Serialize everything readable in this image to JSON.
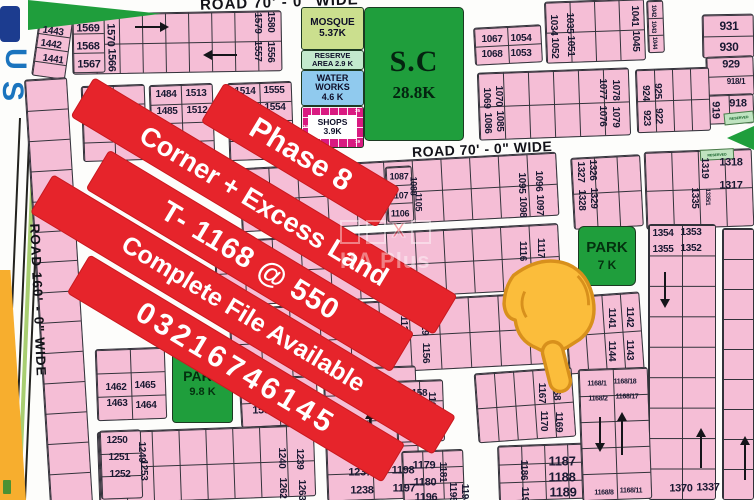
{
  "page": {
    "width": 754,
    "height": 500
  },
  "colors": {
    "plot_pink": "#F5BED6",
    "block_line": "#32323a",
    "label_text": "#191932",
    "green": "#1F9E3C",
    "mosque_green": "#CBDF8E",
    "reserve_green": "#C3E9CD",
    "water_blue": "#90CAEE",
    "shops_magenta": "#D91A81",
    "banner_red": "#E6242B",
    "banner_text": "#FFFFFF",
    "hand_fill": "#FBBD3B",
    "hand_stroke": "#D8901C",
    "orange_strip": "#F7AE2E",
    "blue_edge": "#1B74BE",
    "median_green": "#A8CE71"
  },
  "roads": {
    "top": "ROAD 70' - 0\" WIDE",
    "middle": "ROAD 70' - 0\" WIDE",
    "left": "ROAD 160' - 0\" WIDE"
  },
  "banner": {
    "rotation_deg": 31,
    "lines": [
      {
        "text": "Phase 8",
        "cx": 300,
        "cy": 155,
        "w": 205,
        "h": 46,
        "fs": 30,
        "ls": 0
      },
      {
        "text": "Corner + Excess Land",
        "cx": 264,
        "cy": 206,
        "w": 424,
        "h": 46,
        "fs": 27,
        "ls": 0
      },
      {
        "text": "T- 1168 @ 550",
        "cx": 250,
        "cy": 261,
        "w": 356,
        "h": 46,
        "fs": 29,
        "ls": 1
      },
      {
        "text": "Complete File Available",
        "cx": 243,
        "cy": 314,
        "w": 470,
        "h": 45,
        "fs": 25,
        "ls": 0
      },
      {
        "text": "03216746145",
        "cx": 236,
        "cy": 368,
        "w": 368,
        "h": 45,
        "fs": 30,
        "ls": 4
      }
    ]
  },
  "amenities": {
    "mosque": {
      "line1": "MOSQUE",
      "line2": "5.37K"
    },
    "reserve": {
      "line1": "RESERVE",
      "line2": "AREA  2.9 K"
    },
    "water": {
      "line1": "WATER",
      "line2": "WORKS",
      "line3": "4.6 K"
    },
    "shops": {
      "line1": "SHOPS",
      "line2": "3.9K",
      "cells": [
        "34",
        "35",
        "19"
      ]
    },
    "sc": {
      "line1": "S.C",
      "line2": "28.8K"
    },
    "park7": {
      "line1": "PARK",
      "line2": "7 K"
    },
    "park98": {
      "line1": "PARK",
      "line2": "9.8 K"
    },
    "reserved_label": "RESERVED"
  },
  "edge_letters": [
    "U",
    "S"
  ],
  "watermark": {
    "text": "HA Plus",
    "x_glyph": "X"
  },
  "blocks": [
    {
      "x": 35,
      "y": 20,
      "w": 34,
      "h": 58,
      "r": 8,
      "c": 1,
      "rw": 4
    },
    {
      "x": 72,
      "y": 12,
      "w": 210,
      "h": 61,
      "r": -1,
      "c": 9,
      "rw": 2
    },
    {
      "x": 72,
      "y": 13,
      "w": 33,
      "h": 60,
      "r": -1,
      "c": 1,
      "rw": 3
    },
    {
      "x": 82,
      "y": 85,
      "w": 64,
      "h": 76,
      "r": -2,
      "c": 2,
      "rw": 4
    },
    {
      "x": 150,
      "y": 84,
      "w": 64,
      "h": 77,
      "r": -2,
      "c": 2,
      "rw": 4
    },
    {
      "x": 228,
      "y": 82,
      "w": 65,
      "h": 78,
      "r": -2,
      "c": 2,
      "rw": 4
    },
    {
      "x": 474,
      "y": 26,
      "w": 68,
      "h": 38,
      "r": -3,
      "c": 2,
      "rw": 2
    },
    {
      "x": 545,
      "y": 0,
      "w": 100,
      "h": 62,
      "r": -2,
      "c": 4,
      "rw": 2
    },
    {
      "x": 647,
      "y": 0,
      "w": 17,
      "h": 53,
      "r": -2,
      "c": 1,
      "rw": 3
    },
    {
      "x": 702,
      "y": 14,
      "w": 52,
      "h": 44,
      "r": -1,
      "c": 1,
      "rw": 2
    },
    {
      "x": 706,
      "y": 56,
      "w": 48,
      "h": 40,
      "r": -2,
      "c": 1,
      "rw": 2
    },
    {
      "x": 704,
      "y": 94,
      "w": 50,
      "h": 30,
      "r": -2,
      "c": 2,
      "rw": 1
    },
    {
      "x": 636,
      "y": 68,
      "w": 74,
      "h": 64,
      "r": -2,
      "c": 4,
      "rw": 2
    },
    {
      "x": 478,
      "y": 70,
      "w": 152,
      "h": 68,
      "r": -2,
      "c": 6,
      "rw": 2
    },
    {
      "x": 240,
      "y": 160,
      "w": 318,
      "h": 64,
      "r": -3,
      "c": 11,
      "rw": 2
    },
    {
      "x": 386,
      "y": 166,
      "w": 27,
      "h": 56,
      "r": -3,
      "c": 1,
      "rw": 3
    },
    {
      "x": 572,
      "y": 156,
      "w": 70,
      "h": 72,
      "r": -3,
      "c": 3,
      "rw": 2
    },
    {
      "x": 645,
      "y": 150,
      "w": 108,
      "h": 78,
      "r": -2,
      "c": 4,
      "rw": 2
    },
    {
      "x": 215,
      "y": 232,
      "w": 345,
      "h": 66,
      "r": -3,
      "c": 12,
      "rw": 2
    },
    {
      "x": 648,
      "y": 224,
      "w": 68,
      "h": 276,
      "r": 0,
      "c": 2,
      "rw": 9
    },
    {
      "x": 722,
      "y": 228,
      "w": 32,
      "h": 272,
      "r": 0,
      "c": 1,
      "rw": 9
    },
    {
      "x": 566,
      "y": 294,
      "w": 76,
      "h": 78,
      "r": -4,
      "c": 4,
      "rw": 2
    },
    {
      "x": 230,
      "y": 300,
      "w": 330,
      "h": 72,
      "r": -3,
      "c": 11,
      "rw": 2
    },
    {
      "x": 37,
      "y": 78,
      "w": 43,
      "h": 427,
      "r": -3.5,
      "c": 1,
      "rw": 14
    },
    {
      "x": 96,
      "y": 348,
      "w": 70,
      "h": 72,
      "r": -2,
      "c": 2,
      "rw": 3
    },
    {
      "x": 240,
      "y": 377,
      "w": 78,
      "h": 49,
      "r": -3,
      "c": 2,
      "rw": 2
    },
    {
      "x": 98,
      "y": 428,
      "w": 217,
      "h": 72,
      "r": -2,
      "c": 8,
      "rw": 2
    },
    {
      "x": 100,
      "y": 430,
      "w": 42,
      "h": 69,
      "r": -2,
      "c": 1,
      "rw": 3
    },
    {
      "x": 325,
      "y": 367,
      "w": 93,
      "h": 133,
      "r": -2,
      "c": 2,
      "rw": 5
    },
    {
      "x": 396,
      "y": 380,
      "w": 48,
      "h": 62,
      "r": -2,
      "c": 2,
      "rw": 3
    },
    {
      "x": 402,
      "y": 450,
      "w": 62,
      "h": 50,
      "r": -2,
      "c": 3,
      "rw": 3
    },
    {
      "x": 476,
      "y": 370,
      "w": 98,
      "h": 70,
      "r": -4,
      "c": 5,
      "rw": 2
    },
    {
      "x": 498,
      "y": 444,
      "w": 94,
      "h": 56,
      "r": -2,
      "c": 4,
      "rw": 3
    },
    {
      "x": 580,
      "y": 368,
      "w": 70,
      "h": 132,
      "r": -2,
      "c": 2,
      "rw": 5
    }
  ],
  "plot_labels": [
    {
      "t": "1443",
      "x": 53,
      "y": 32,
      "r": 8
    },
    {
      "t": "1442",
      "x": 51,
      "y": 45,
      "r": 8
    },
    {
      "t": "1441",
      "x": 53,
      "y": 60,
      "r": 8
    },
    {
      "t": "1569",
      "x": 88,
      "y": 29,
      "s": 11
    },
    {
      "t": "1568",
      "x": 88,
      "y": 47,
      "s": 11
    },
    {
      "t": "1567",
      "x": 89,
      "y": 65,
      "s": 11
    },
    {
      "t": "1570",
      "x": 110,
      "y": 35,
      "r": 90,
      "s": 11
    },
    {
      "t": "1566",
      "x": 111,
      "y": 60,
      "r": 90,
      "s": 11
    },
    {
      "t": "1579",
      "x": 257,
      "y": 23,
      "r": 90
    },
    {
      "t": "1580",
      "x": 270,
      "y": 22,
      "r": 90
    },
    {
      "t": "1557",
      "x": 257,
      "y": 51,
      "r": 90
    },
    {
      "t": "1556",
      "x": 270,
      "y": 52,
      "r": 90
    },
    {
      "t": "1444",
      "x": 97,
      "y": 99
    },
    {
      "t": "1445",
      "x": 97,
      "y": 116
    },
    {
      "t": "1484",
      "x": 166,
      "y": 95
    },
    {
      "t": "1513",
      "x": 196,
      "y": 94
    },
    {
      "t": "1485",
      "x": 167,
      "y": 112
    },
    {
      "t": "1512",
      "x": 197,
      "y": 111
    },
    {
      "t": "1514",
      "x": 245,
      "y": 92
    },
    {
      "t": "1555",
      "x": 274,
      "y": 91
    },
    {
      "t": "1515",
      "x": 247,
      "y": 109
    },
    {
      "t": "1554",
      "x": 275,
      "y": 108
    },
    {
      "t": "1067",
      "x": 492,
      "y": 40
    },
    {
      "t": "1054",
      "x": 521,
      "y": 39
    },
    {
      "t": "1068",
      "x": 492,
      "y": 55
    },
    {
      "t": "1053",
      "x": 521,
      "y": 54
    },
    {
      "t": "1034",
      "x": 553,
      "y": 25,
      "r": 90
    },
    {
      "t": "1052",
      "x": 554,
      "y": 48,
      "r": 90
    },
    {
      "t": "1035",
      "x": 569,
      "y": 23,
      "r": 90
    },
    {
      "t": "1051",
      "x": 570,
      "y": 46,
      "r": 90
    },
    {
      "t": "1041",
      "x": 634,
      "y": 16,
      "r": 90
    },
    {
      "t": "1045",
      "x": 635,
      "y": 41,
      "r": 90
    },
    {
      "t": "1042",
      "x": 653,
      "y": 11,
      "r": 90,
      "s": 6
    },
    {
      "t": "1043",
      "x": 653,
      "y": 27,
      "r": 90,
      "s": 6
    },
    {
      "t": "1044",
      "x": 654,
      "y": 43,
      "r": 90,
      "s": 6
    },
    {
      "t": "931",
      "x": 729,
      "y": 26,
      "s": 12
    },
    {
      "t": "930",
      "x": 729,
      "y": 47,
      "s": 12
    },
    {
      "t": "929",
      "x": 731,
      "y": 65,
      "s": 11
    },
    {
      "t": "918/1",
      "x": 736,
      "y": 82,
      "s": 8
    },
    {
      "t": "918",
      "x": 738,
      "y": 104,
      "s": 11
    },
    {
      "t": "919",
      "x": 715,
      "y": 110,
      "r": 90,
      "s": 11
    },
    {
      "t": "924",
      "x": 645,
      "y": 93,
      "r": 90
    },
    {
      "t": "925",
      "x": 657,
      "y": 91,
      "r": 90
    },
    {
      "t": "923",
      "x": 646,
      "y": 118,
      "r": 90
    },
    {
      "t": "922",
      "x": 658,
      "y": 116,
      "r": 90
    },
    {
      "t": "1069",
      "x": 486,
      "y": 98,
      "r": 90
    },
    {
      "t": "1070",
      "x": 498,
      "y": 96,
      "r": 90
    },
    {
      "t": "1086",
      "x": 487,
      "y": 123,
      "r": 90
    },
    {
      "t": "1085",
      "x": 499,
      "y": 121,
      "r": 90
    },
    {
      "t": "1077",
      "x": 602,
      "y": 89,
      "r": 90
    },
    {
      "t": "1078",
      "x": 615,
      "y": 90,
      "r": 90
    },
    {
      "t": "1076",
      "x": 602,
      "y": 116,
      "r": 90
    },
    {
      "t": "1079",
      "x": 615,
      "y": 117,
      "r": 90
    },
    {
      "t": "1087",
      "x": 399,
      "y": 177,
      "s": 9
    },
    {
      "t": "1088",
      "x": 413,
      "y": 186,
      "r": 90,
      "s": 9
    },
    {
      "t": "1107",
      "x": 399,
      "y": 196,
      "s": 9
    },
    {
      "t": "1105",
      "x": 418,
      "y": 202,
      "r": 90,
      "s": 9
    },
    {
      "t": "1106",
      "x": 400,
      "y": 214,
      "s": 9
    },
    {
      "t": "1095",
      "x": 521,
      "y": 183,
      "r": 90
    },
    {
      "t": "1096",
      "x": 538,
      "y": 181,
      "r": 90
    },
    {
      "t": "1098",
      "x": 522,
      "y": 207,
      "r": 90
    },
    {
      "t": "1097",
      "x": 539,
      "y": 205,
      "r": 90
    },
    {
      "t": "1327",
      "x": 580,
      "y": 172,
      "r": 90
    },
    {
      "t": "1326",
      "x": 592,
      "y": 170,
      "r": 90
    },
    {
      "t": "1328",
      "x": 581,
      "y": 200,
      "r": 90
    },
    {
      "t": "1329",
      "x": 593,
      "y": 198,
      "r": 90
    },
    {
      "t": "1319",
      "x": 704,
      "y": 168,
      "r": 90
    },
    {
      "t": "1318",
      "x": 731,
      "y": 163,
      "s": 11
    },
    {
      "t": "1335",
      "x": 694,
      "y": 198,
      "r": 90
    },
    {
      "t": "1335/1",
      "x": 707,
      "y": 197,
      "r": 90,
      "s": 6
    },
    {
      "t": "1317",
      "x": 731,
      "y": 186,
      "s": 11
    },
    {
      "t": "1116",
      "x": 522,
      "y": 251,
      "r": 90
    },
    {
      "t": "1117",
      "x": 540,
      "y": 248,
      "r": 90
    },
    {
      "t": "1354",
      "x": 663,
      "y": 234
    },
    {
      "t": "1353",
      "x": 691,
      "y": 233
    },
    {
      "t": "1355",
      "x": 663,
      "y": 250
    },
    {
      "t": "1352",
      "x": 691,
      "y": 249
    },
    {
      "t": "1370",
      "x": 681,
      "y": 489,
      "s": 11
    },
    {
      "t": "1337",
      "x": 708,
      "y": 488,
      "s": 11
    },
    {
      "t": "1141",
      "x": 611,
      "y": 318,
      "r": 90
    },
    {
      "t": "1142",
      "x": 629,
      "y": 317,
      "r": 90
    },
    {
      "t": "1144",
      "x": 611,
      "y": 351,
      "r": 90
    },
    {
      "t": "1143",
      "x": 629,
      "y": 350,
      "r": 90
    },
    {
      "t": "1128",
      "x": 403,
      "y": 326,
      "r": 90
    },
    {
      "t": "1129",
      "x": 424,
      "y": 325,
      "r": 90
    },
    {
      "t": "1156",
      "x": 425,
      "y": 353,
      "r": 90
    },
    {
      "t": "1462",
      "x": 116,
      "y": 388
    },
    {
      "t": "1465",
      "x": 145,
      "y": 386
    },
    {
      "t": "1463",
      "x": 117,
      "y": 404
    },
    {
      "t": "1464",
      "x": 146,
      "y": 406
    },
    {
      "t": "1533",
      "x": 263,
      "y": 394,
      "s": 11
    },
    {
      "t": "1536",
      "x": 294,
      "y": 392,
      "s": 11
    },
    {
      "t": "1534",
      "x": 264,
      "y": 411,
      "s": 11
    },
    {
      "t": "1535",
      "x": 296,
      "y": 413,
      "s": 11
    },
    {
      "t": "1250",
      "x": 117,
      "y": 441
    },
    {
      "t": "1249",
      "x": 141,
      "y": 452,
      "r": 90
    },
    {
      "t": "1251",
      "x": 119,
      "y": 458
    },
    {
      "t": "1253",
      "x": 143,
      "y": 470,
      "r": 90
    },
    {
      "t": "1252",
      "x": 120,
      "y": 475
    },
    {
      "t": "1240",
      "x": 281,
      "y": 458,
      "r": 90
    },
    {
      "t": "1239",
      "x": 299,
      "y": 459,
      "r": 90
    },
    {
      "t": "1262",
      "x": 282,
      "y": 488,
      "r": 90
    },
    {
      "t": "1263",
      "x": 301,
      "y": 490,
      "r": 90
    },
    {
      "t": "1237",
      "x": 360,
      "y": 473,
      "s": 11
    },
    {
      "t": "1198",
      "x": 403,
      "y": 471,
      "s": 11
    },
    {
      "t": "1238",
      "x": 362,
      "y": 491,
      "s": 11
    },
    {
      "t": "1197",
      "x": 404,
      "y": 489,
      "s": 11
    },
    {
      "t": "1158",
      "x": 417,
      "y": 394
    },
    {
      "t": "1160",
      "x": 431,
      "y": 402,
      "r": 90
    },
    {
      "t": "1159",
      "x": 417,
      "y": 412
    },
    {
      "t": "1177",
      "x": 433,
      "y": 425,
      "r": 90
    },
    {
      "t": "1178",
      "x": 419,
      "y": 431
    },
    {
      "t": "1179",
      "x": 424,
      "y": 466,
      "s": 11
    },
    {
      "t": "1181",
      "x": 442,
      "y": 472,
      "r": 90
    },
    {
      "t": "1180",
      "x": 425,
      "y": 483,
      "s": 11
    },
    {
      "t": "1196",
      "x": 426,
      "y": 498,
      "s": 11
    },
    {
      "t": "1195",
      "x": 452,
      "y": 492,
      "r": 90
    },
    {
      "t": "1194",
      "x": 464,
      "y": 494,
      "r": 90
    },
    {
      "t": "1167",
      "x": 541,
      "y": 393,
      "r": 90
    },
    {
      "t": "1168",
      "x": 556,
      "y": 390,
      "r": 90
    },
    {
      "t": "1170",
      "x": 543,
      "y": 421,
      "r": 90
    },
    {
      "t": "1169",
      "x": 558,
      "y": 422,
      "r": 90
    },
    {
      "t": "1186",
      "x": 523,
      "y": 470,
      "r": 90
    },
    {
      "t": "1190",
      "x": 524,
      "y": 497,
      "r": 90
    },
    {
      "t": "1187",
      "x": 562,
      "y": 461,
      "s": 13
    },
    {
      "t": "1188",
      "x": 562,
      "y": 477,
      "s": 13
    },
    {
      "t": "1189",
      "x": 563,
      "y": 492,
      "s": 13
    },
    {
      "t": "1168/1",
      "x": 597,
      "y": 384,
      "s": 7
    },
    {
      "t": "1168/18",
      "x": 625,
      "y": 382,
      "s": 7
    },
    {
      "t": "1168/2",
      "x": 598,
      "y": 399,
      "s": 7
    },
    {
      "t": "1168/17",
      "x": 627,
      "y": 397,
      "s": 7
    },
    {
      "t": "1168/8",
      "x": 604,
      "y": 493,
      "s": 7
    },
    {
      "t": "1168/11",
      "x": 631,
      "y": 491,
      "s": 7
    }
  ],
  "arrows": [
    {
      "x": 135,
      "y": 27,
      "dir": "right",
      "len": 32
    },
    {
      "x": 205,
      "y": 55,
      "dir": "left",
      "len": 32
    },
    {
      "x": 665,
      "y": 272,
      "dir": "down",
      "len": 34
    },
    {
      "x": 370,
      "y": 412,
      "dir": "up",
      "len": 34
    },
    {
      "x": 600,
      "y": 417,
      "dir": "down",
      "len": 33
    },
    {
      "x": 622,
      "y": 414,
      "dir": "up",
      "len": 41
    },
    {
      "x": 701,
      "y": 430,
      "dir": "up",
      "len": 38
    },
    {
      "x": 745,
      "y": 438,
      "dir": "up",
      "len": 42
    },
    {
      "x": 143,
      "y": 138,
      "dir": "line",
      "len": 20
    }
  ]
}
